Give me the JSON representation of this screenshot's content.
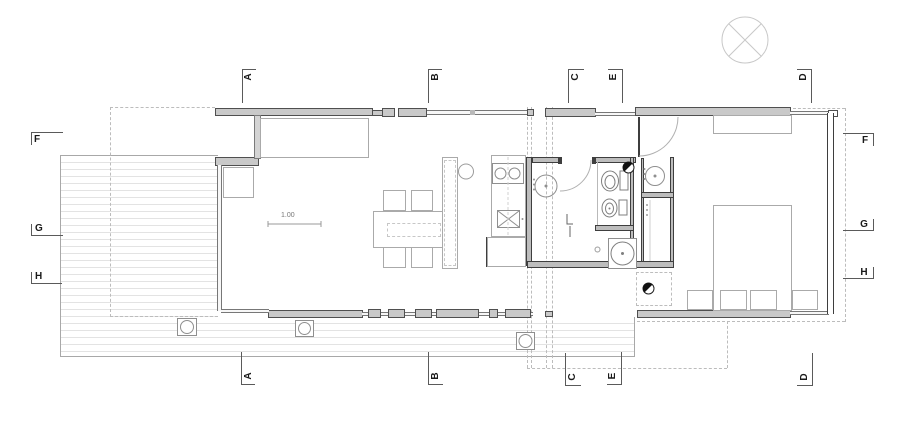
{
  "section_markers": {
    "top": [
      {
        "label": "A"
      },
      {
        "label": "B"
      },
      {
        "label": "C"
      },
      {
        "label": "E"
      },
      {
        "label": "D"
      }
    ],
    "bottom": [
      {
        "label": "A"
      },
      {
        "label": "B"
      },
      {
        "label": "C"
      },
      {
        "label": "E"
      },
      {
        "label": "D"
      }
    ],
    "left": [
      {
        "label": "F"
      },
      {
        "label": "G"
      },
      {
        "label": "H"
      }
    ],
    "right": [
      {
        "label": "F"
      },
      {
        "label": "G"
      },
      {
        "label": "H"
      }
    ]
  },
  "annotations": {
    "scale_dimension": "1.00"
  },
  "colors": {
    "wall_fill": "#c9c9c9",
    "wall_stroke": "#4f4f4f",
    "furniture_stroke": "#9b9b9b",
    "deck_line": "#e3e3e3",
    "dashed_line": "#bcbcbc",
    "marker_text": "#1a1a1a"
  },
  "icons": [
    "compass-icon",
    "door-swing-icon",
    "stove-icon",
    "kitchen-sink-icon",
    "laundry-basin-icon",
    "toilet-icon",
    "bidet-icon",
    "washbasin-icon",
    "washing-machine-icon",
    "drain-icon",
    "planter-icon",
    "light-switch-icon"
  ]
}
